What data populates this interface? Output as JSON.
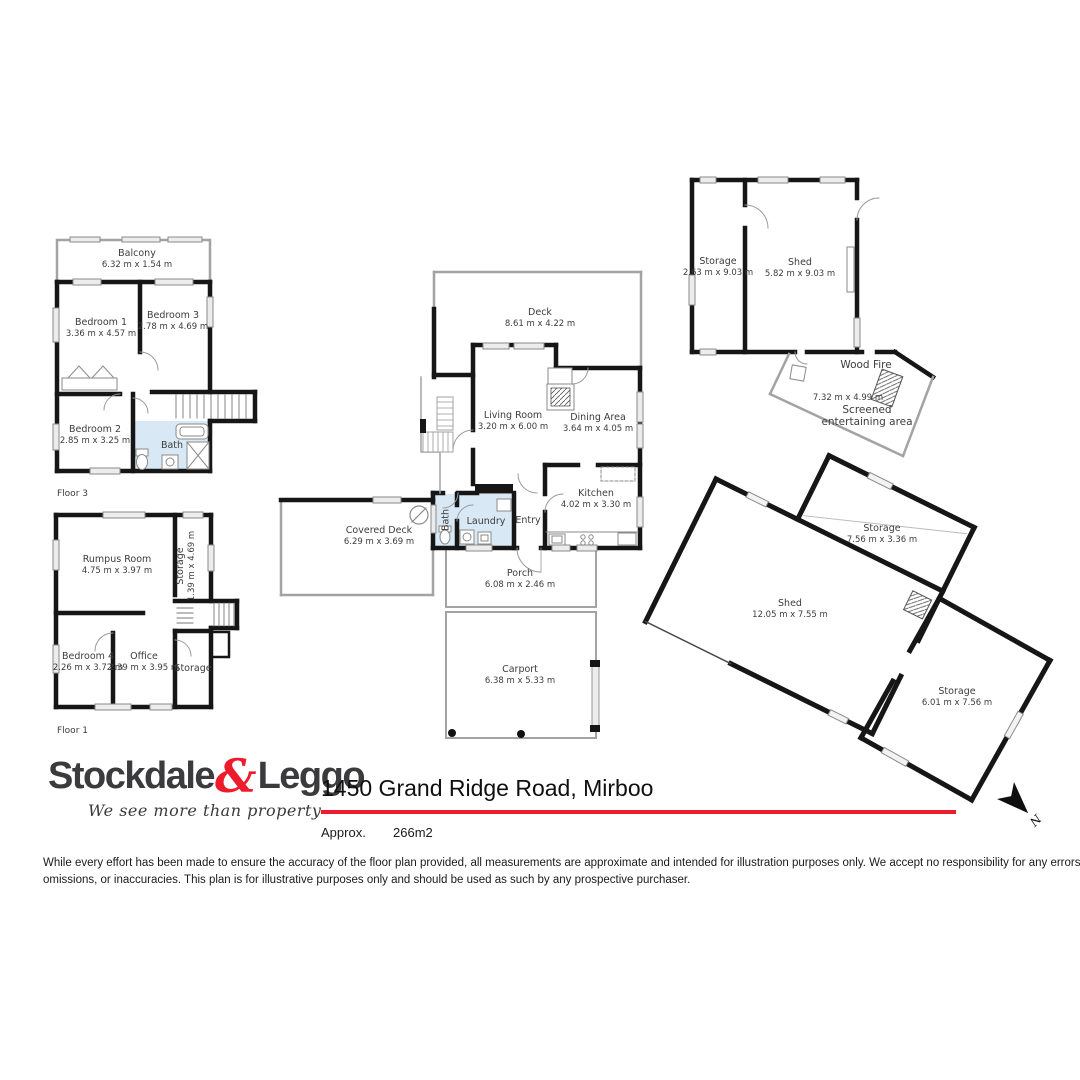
{
  "floors": {
    "floor3": {
      "tag": "Floor 3",
      "balcony": {
        "name": "Balcony",
        "dims": "6.32 m x 1.54 m"
      },
      "bedroom1": {
        "name": "Bedroom 1",
        "dims": "3.36 m x 4.57 m"
      },
      "bedroom3": {
        "name": "Bedroom 3",
        "dims": "2.78 m x 4.69 m"
      },
      "bedroom2": {
        "name": "Bedroom 2",
        "dims": "2.85 m x 3.25 m"
      },
      "bath": {
        "name": "Bath"
      }
    },
    "floor1": {
      "tag": "Floor 1",
      "rumpus": {
        "name": "Rumpus Room",
        "dims": "4.75 m x 3.97 m"
      },
      "storage_side": {
        "name": "Storage",
        "dims": "1.39 m x 4.69 m"
      },
      "bedroom4": {
        "name": "Bedroom 4",
        "dims": "2.26 m x 3.72 m"
      },
      "office": {
        "name": "Office",
        "dims": "2.39 m x 3.95 m"
      },
      "storage_corner": {
        "name": "Storage"
      }
    },
    "main": {
      "deck": {
        "name": "Deck",
        "dims": "8.61 m x 4.22 m"
      },
      "living": {
        "name": "Living Room",
        "dims": "3.20 m x 6.00 m"
      },
      "dining": {
        "name": "Dining Area",
        "dims": "3.64 m x 4.05 m"
      },
      "kitchen": {
        "name": "Kitchen",
        "dims": "4.02 m x 3.30 m"
      },
      "entry": {
        "name": "Entry"
      },
      "laundry": {
        "name": "Laundry"
      },
      "bath": {
        "name": "Bath"
      },
      "covered_deck": {
        "name": "Covered Deck",
        "dims": "6.29 m x 3.69 m"
      },
      "porch": {
        "name": "Porch",
        "dims": "6.08 m x 2.46 m"
      },
      "carport": {
        "name": "Carport",
        "dims": "6.38 m x 5.33 m"
      }
    },
    "outbuildings": {
      "storage_tr": {
        "name": "Storage",
        "dims": "2.63 m x 9.03 m"
      },
      "shed_tr": {
        "name": "Shed",
        "dims": "5.82 m x 9.03 m"
      },
      "wood_fire": {
        "name": "Wood Fire"
      },
      "screened": {
        "name": "Screened entertaining area",
        "dims": "7.32 m x 4.99 m"
      },
      "big_shed": {
        "name": "Shed",
        "dims": "12.05 m x 7.55 m"
      },
      "storage_top": {
        "name": "Storage",
        "dims": "7.56 m x 3.36 m"
      },
      "storage_right": {
        "name": "Storage",
        "dims": "6.01 m x 7.56 m"
      }
    }
  },
  "compass": {
    "north": "N"
  },
  "footer": {
    "brand_left": "Stockdale",
    "brand_amp": "&",
    "brand_right": "Leggo",
    "tagline": "We see more than property",
    "title": "1450 Grand Ridge Road, Mirboo",
    "approx_label": "Approx.",
    "area": "266m2",
    "disclaimer_line1": "While every effort has been made to ensure the accuracy of the floor plan provided, all measurements are approximate and intended for illustration purposes only. We accept no responsibility for any errors,",
    "disclaimer_line2": "omissions, or inaccuracies. This plan is for illustrative purposes only and should be used as such by any prospective purchaser."
  },
  "colors": {
    "accent_red": "#ed1c2d",
    "wall": "#161616",
    "wet_area": "#d8e9f5"
  }
}
